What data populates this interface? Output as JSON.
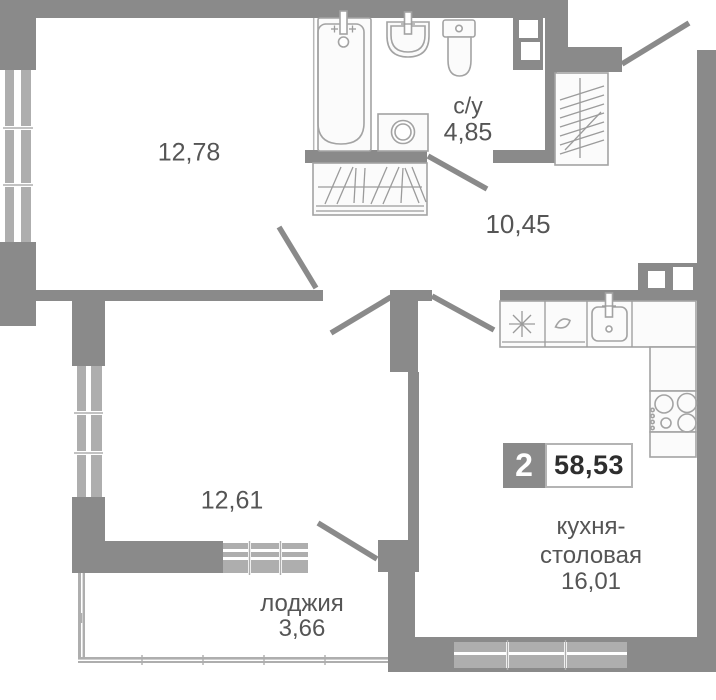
{
  "plan": {
    "title": "2-room apartment floor plan",
    "badge": {
      "rooms": "2",
      "total_area": "58,53"
    },
    "rooms": {
      "living": {
        "area": "12,78"
      },
      "bathroom": {
        "name": "с/у",
        "area": "4,85"
      },
      "hallway": {
        "area": "10,45"
      },
      "bedroom": {
        "area": "12,61"
      },
      "loggia": {
        "name": "лоджия",
        "area": "3,66"
      },
      "kitchen": {
        "name_line1": "кухня-",
        "name_line2": "столовая",
        "area": "16,01"
      }
    },
    "colors": {
      "wall": "#8a8a8a",
      "window": "#aeaeae",
      "fixture": "#a3a3a3",
      "label": "#555555",
      "badge_bg": "#8a8a8a",
      "badge_text": "#ffffff",
      "area_text": "#2e2e2e",
      "bg": "#ffffff"
    }
  }
}
